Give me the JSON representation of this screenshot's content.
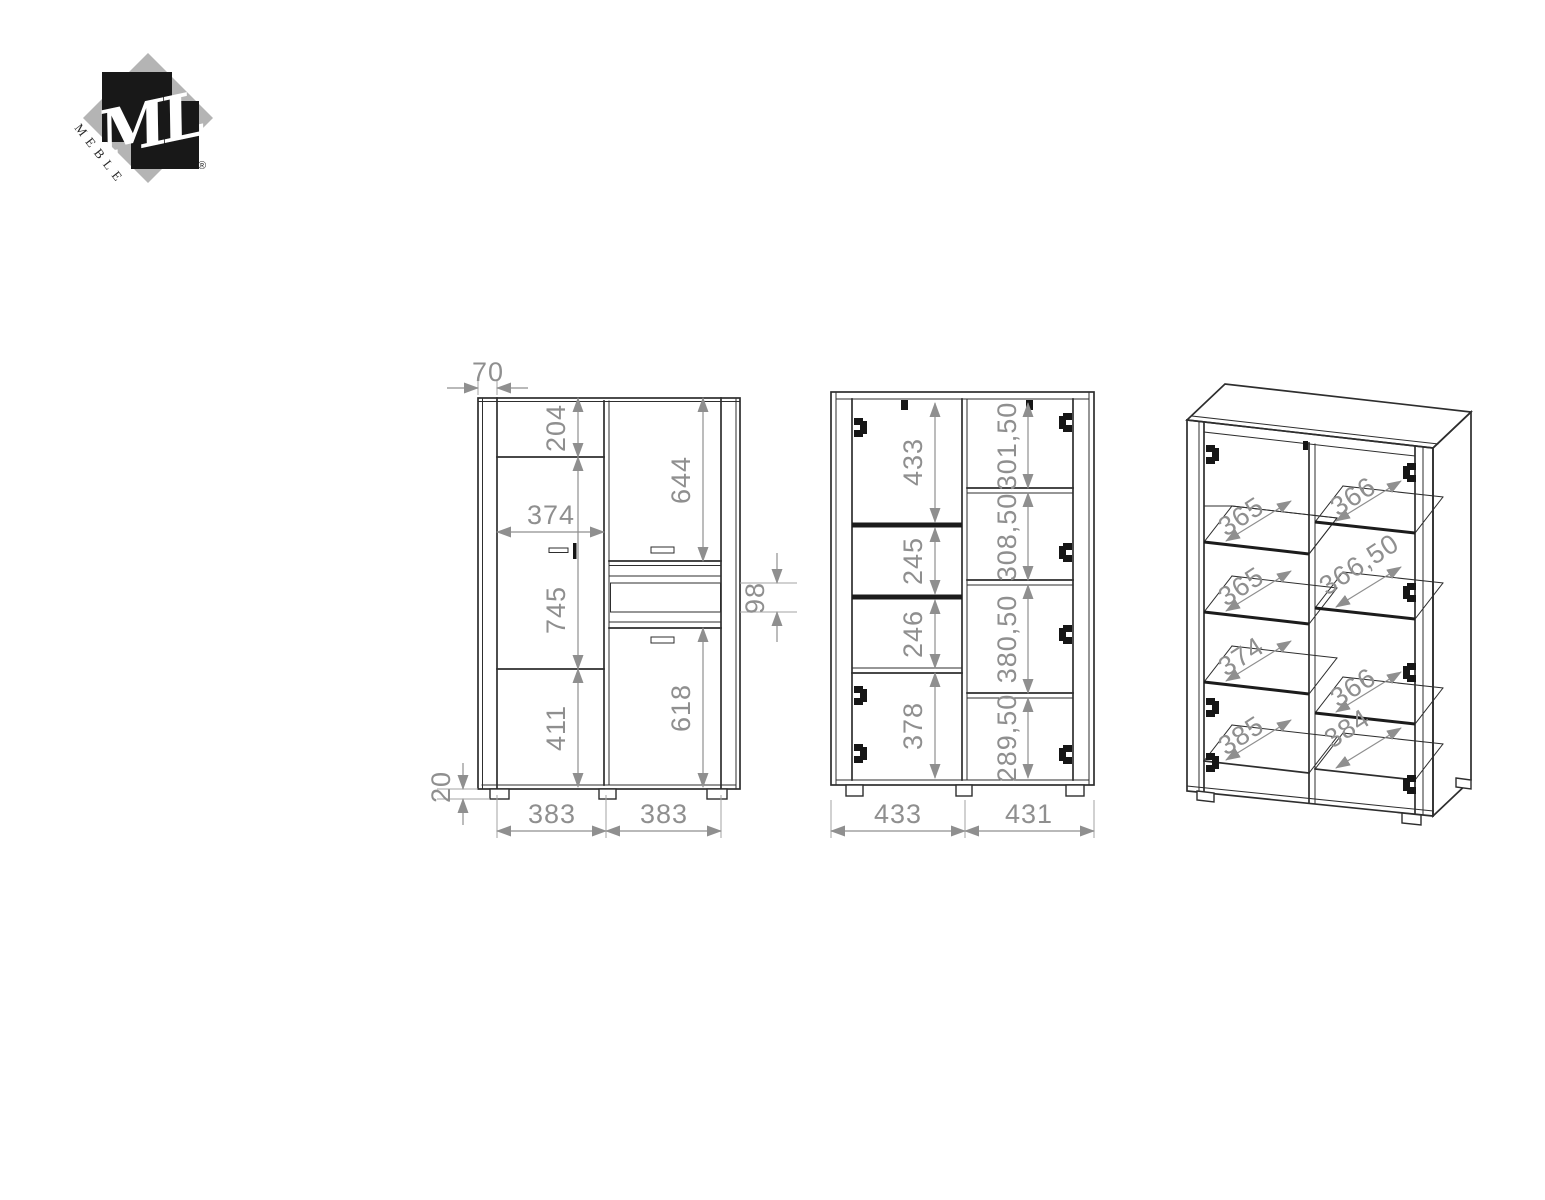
{
  "logo": {
    "monogram": "ML",
    "wordmark": "MEBLE",
    "registered_mark": "®"
  },
  "colors": {
    "line": "#2e2e2e",
    "dimension": "#8f8f8f",
    "logo_diamond_gray": "#b4b4b4",
    "logo_square_black": "#181818"
  },
  "front_view": {
    "side_panel_width": "70",
    "left_sections": [
      "204",
      "745",
      "411"
    ],
    "left_door_width": "374",
    "right_sections": [
      "644",
      "618"
    ],
    "insert_height": "98",
    "foot_height": "20",
    "bottom_widths": [
      "383",
      "383"
    ]
  },
  "section_view": {
    "left_sections": [
      "433",
      "245",
      "246",
      "378"
    ],
    "right_sections": [
      "301,50",
      "308,50",
      "380,50",
      "289,50"
    ],
    "bottom_widths": [
      "433",
      "431"
    ]
  },
  "perspective_view": {
    "left_shelf_widths": [
      "365",
      "365",
      "374",
      "385"
    ],
    "right_shelf_widths": [
      "366",
      "366,50",
      "366",
      "384"
    ]
  }
}
